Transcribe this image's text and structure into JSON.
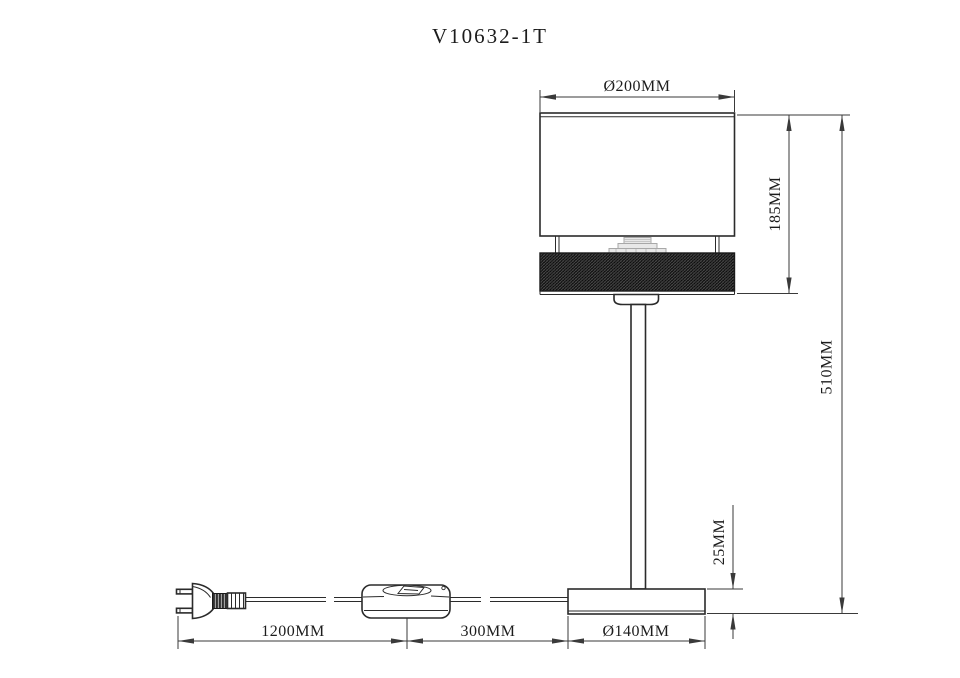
{
  "title": "V10632-1T",
  "drawing": {
    "labels": {
      "shade_diameter": "Ø200MM",
      "shade_height": "185MM",
      "total_height": "510MM",
      "base_height": "25MM",
      "base_diameter": "Ø140MM",
      "cord_length": "1200MM",
      "switch_section": "300MM"
    },
    "colors": {
      "background": "#ffffff",
      "line": "#2b2b2b",
      "dimension_line": "#3a3a3a",
      "text": "#1c1c1c",
      "band_fill": "#0d0d0d",
      "socket_gray": "#a8a8a8"
    }
  }
}
